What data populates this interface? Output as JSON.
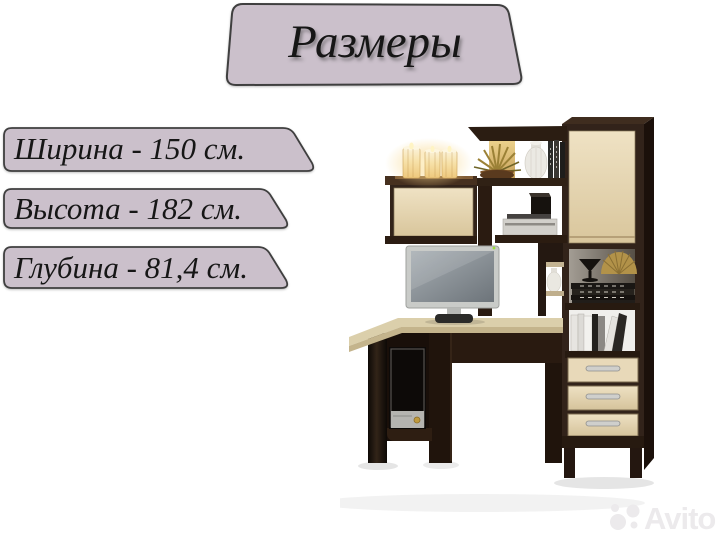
{
  "page": {
    "background": "#ffffff"
  },
  "banner": {
    "title": "Размеры"
  },
  "dimensions": {
    "width": "Ширина - 150 см.",
    "height": "Высота - 182 см.",
    "depth": "Глубина - 81,4 см."
  },
  "watermark": {
    "brand": "Avito",
    "logo": "avito-circles-icon"
  },
  "colors": {
    "banner_fill": "#cbc0cb",
    "banner_border": "#3f3f3f",
    "text": "#161616",
    "watermark": "#eceaec",
    "oak": "#e8d9b9",
    "wenge": "#32231a",
    "desktop": "#dbcfab"
  }
}
